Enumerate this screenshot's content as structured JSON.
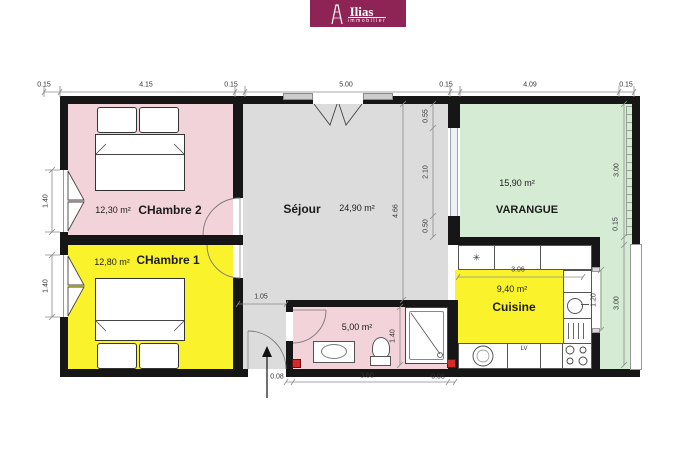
{
  "logo": {
    "title": "Ilias",
    "subtitle": "immobilier"
  },
  "rooms": {
    "chambre2": {
      "area": "12,30 m²",
      "name": "CHambre 2"
    },
    "chambre1": {
      "area": "12,80 m²",
      "name": "CHambre 1"
    },
    "sejour": {
      "name": "Séjour",
      "area": "24,90 m²"
    },
    "salle_eau": {
      "area": "5,00 m²"
    },
    "cuisine": {
      "area": "9,40 m²",
      "name": "Cuisine",
      "appliance_label": "LV"
    },
    "varangue": {
      "area": "15,90 m²",
      "name": "VARANGUE"
    }
  },
  "dimensions": {
    "top": [
      "0.15",
      "4.15",
      "0.15",
      "5.00",
      "0.15",
      "4.09",
      "0.15"
    ],
    "left_windows": [
      "1.40",
      "1.40"
    ],
    "sejour_wall": [
      "0.55",
      "2.10",
      "0.50"
    ],
    "sejour_depth": "4.66",
    "varangue_right": [
      "3.00",
      "0.15",
      "3.00"
    ],
    "cuisine_width": "3.06",
    "varangue_opening": "1.20",
    "hall_width": "1.05",
    "bath_depth": "1.40",
    "bottom": [
      "0.08",
      "3.60",
      "0.08"
    ]
  },
  "symbols": {
    "light_fixture": "✳"
  },
  "colors": {
    "bedroom_pink": "#f3d3da",
    "room_yellow": "#faf32b",
    "sejour_gray": "#dcdcdc",
    "varangue_green": "#d5ebd4",
    "wall_black": "#161616",
    "logo_magenta": "#8e2456",
    "post_red": "#d42a2a"
  }
}
